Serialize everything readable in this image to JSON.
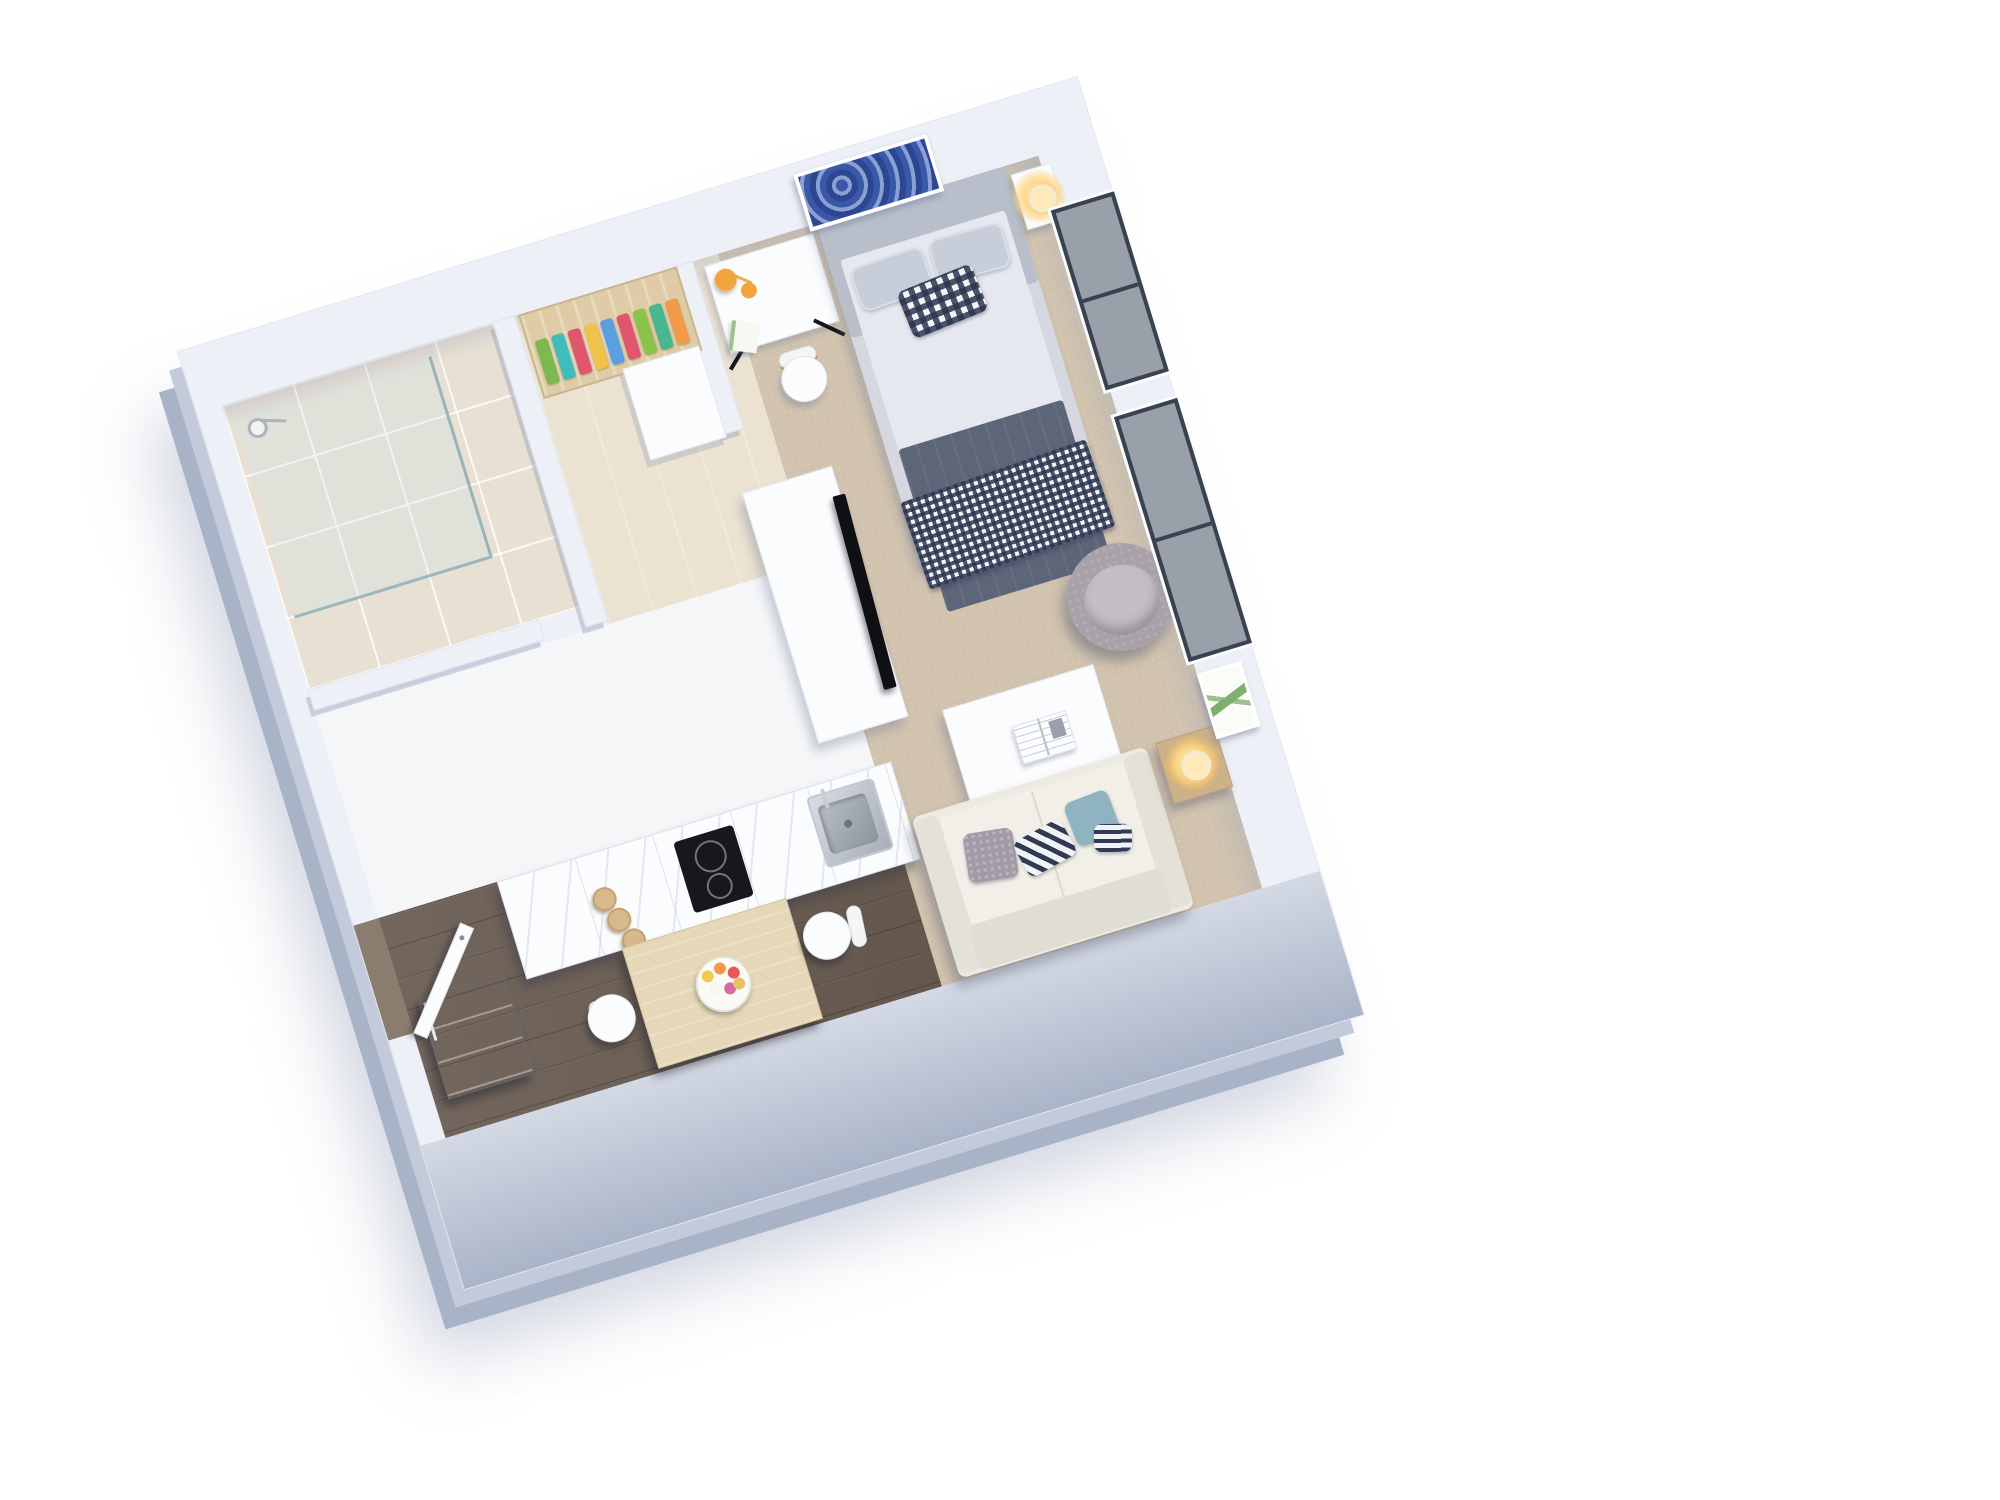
{
  "scene": {
    "type": "3d-floor-plan",
    "view": "isometric top-down render",
    "rooms": [
      "bathroom",
      "wardrobe-nook",
      "kitchen",
      "dining-area",
      "sleeping-area",
      "living-area",
      "entry"
    ],
    "objects": [
      "walk-in-glass-shower",
      "shower-head",
      "open-wardrobe-with-clothes",
      "sliding-door",
      "desk",
      "orange-desk-lamp",
      "notebook",
      "desk-chair",
      "double-bed",
      "headboard",
      "pillows",
      "gingham-accent-pillow",
      "gray-blanket",
      "gingham-throw",
      "nightstand",
      "brass-table-lamp",
      "tv-cabinet",
      "tv",
      "kitchen-counter",
      "induction-cooktop",
      "stainless-sink",
      "wooden-jars",
      "refrigerator",
      "dining-table",
      "fruit-plate",
      "dining-chairs",
      "entry-door",
      "sofa",
      "throw-pillows",
      "coffee-table",
      "open-magazine",
      "armchair",
      "side-table",
      "lit-table-lamp",
      "window",
      "sliding-glass-window",
      "blue-abstract-wall-art",
      "botanical-picture-frame"
    ]
  },
  "palette": {
    "background": "#ffffff",
    "wall": "#edf0f6",
    "wall_face": "#aab4c8",
    "carpet": "#d1c3ae",
    "tile_floor": "#e7e0d3",
    "nook_floor": "#ebe2d2",
    "corridor_floor": "#f4f6f8",
    "wood_floor": "#6b5e54",
    "threshold_wood": "#8a7c6f",
    "white_furniture": "#fbfcfe",
    "closet_wood": "#dfcca6",
    "dining_wood": "#e6d7b8",
    "side_wood": "#cdb188",
    "jar_wood": "#d8b98b",
    "bed_frame": "#d5d8df",
    "headboard": "#b9bfca",
    "mattress": "#e5e8ee",
    "pillow": "#c7ceda",
    "blanket": "#5d6578",
    "gingham_navy": "#2c3550",
    "sofa": "#edeae2",
    "sofa_arm": "#e4e1d8",
    "sofa_back": "#e0ddd3",
    "armchair": "#a8a1a8",
    "armchair_seat": "#c5bec4",
    "accent_orange": "#f2a53c",
    "lamp_glow": "#ffd98f",
    "cooktop_black": "#17181c",
    "tv_black": "#0e1013",
    "steel": "#9aa1ab",
    "window_frame": "#39424f",
    "window_glass": "#9aa0a9",
    "art_blue": "#32509f",
    "plant_green": "#7fae6f"
  },
  "wardrobe": {
    "clothes_colors": [
      "#7cb950",
      "#3fbdbd",
      "#e0566c",
      "#f0c24a",
      "#5a9fe0",
      "#e0566c",
      "#8bc34a",
      "#46b78e",
      "#f2994a"
    ]
  },
  "dining": {
    "fruit_colors": [
      "#f2c94c",
      "#f2994a",
      "#eb5757",
      "#f7f7f2",
      "#d96aa0",
      "#e8c06a"
    ]
  }
}
